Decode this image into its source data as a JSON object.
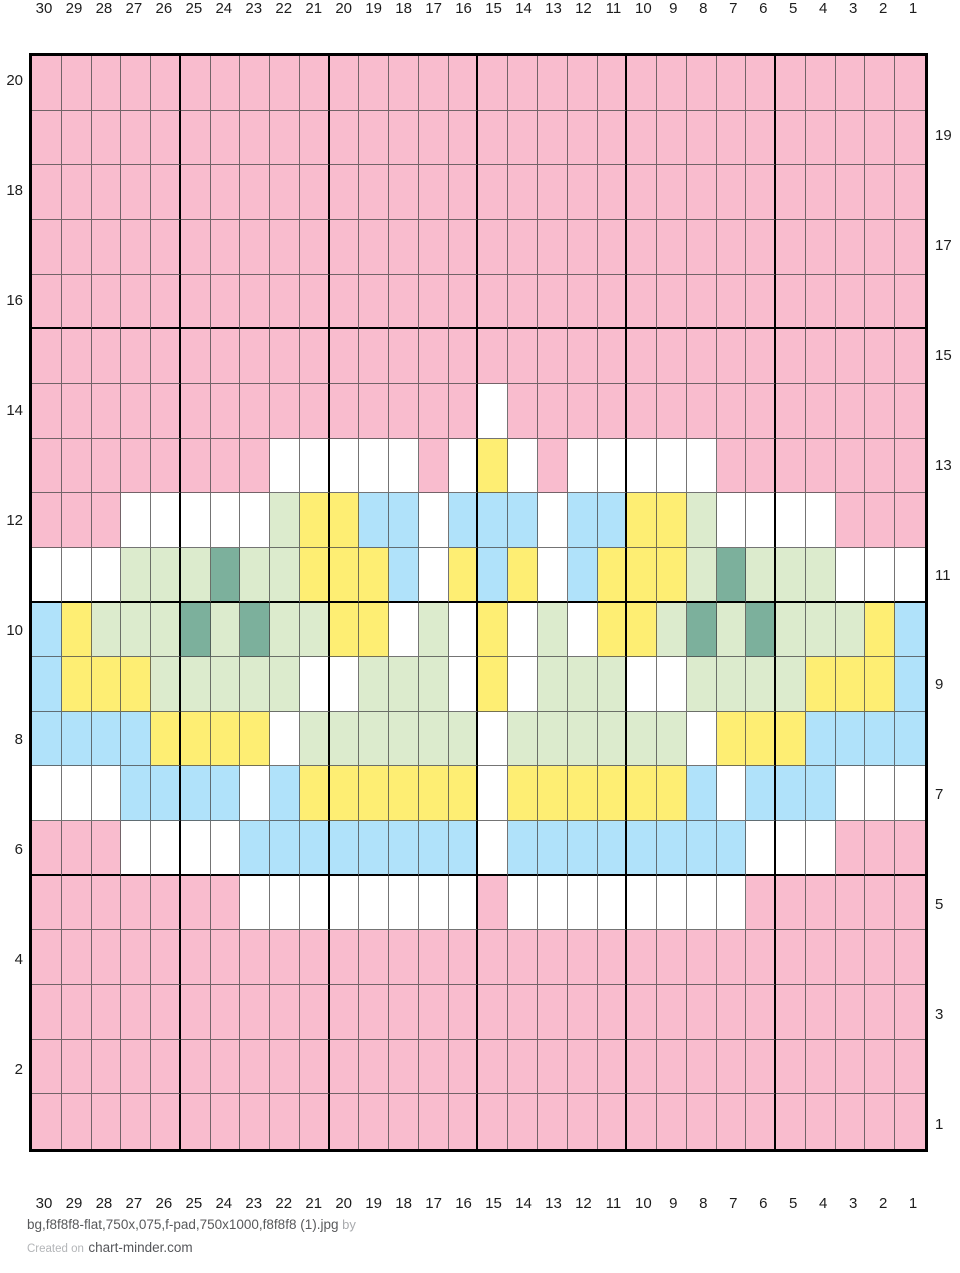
{
  "page": {
    "background": "#ffffff"
  },
  "footer": {
    "filename": "bg,f8f8f8-flat,750x,075,f-pad,750x1000,f8f8f8 (1).jpg",
    "by_label": "by",
    "created_on_label": "Created on",
    "site_link": "chart-minder.com"
  },
  "chart_data": {
    "type": "heatmap",
    "title": "",
    "description": "30-stitch by 20-row knitting colorwork chart with crown-like motif",
    "grid": {
      "columns": 30,
      "rows": 20,
      "thick_line_every": 5,
      "column_numbering": "right-to-left (30 at left edge, 1 at right edge)",
      "row_numbering": "bottom-to-top (even numbers labeled on left, odd on right)"
    },
    "column_labels": [
      "30",
      "29",
      "28",
      "27",
      "26",
      "25",
      "24",
      "23",
      "22",
      "21",
      "20",
      "19",
      "18",
      "17",
      "16",
      "15",
      "14",
      "13",
      "12",
      "11",
      "10",
      "9",
      "8",
      "7",
      "6",
      "5",
      "4",
      "3",
      "2",
      "1"
    ],
    "palette": {
      "P": "#f9bcce",
      "W": "#ffffff",
      "Y": "#feee73",
      "B": "#b0e2fa",
      "G": "#dcebcd",
      "D": "#7cb09c"
    },
    "palette_names": {
      "P": "pink",
      "W": "white",
      "Y": "yellow",
      "B": "light-blue",
      "G": "light-green",
      "D": "teal-green"
    },
    "rows": [
      {
        "number": 20,
        "label_side": "left",
        "cells": "PPPPPPPPPPPPPPPPPPPPPPPPPPPPPP"
      },
      {
        "number": 19,
        "label_side": "right",
        "cells": "PPPPPPPPPPPPPPPPPPPPPPPPPPPPPP"
      },
      {
        "number": 18,
        "label_side": "left",
        "cells": "PPPPPPPPPPPPPPPPPPPPPPPPPPPPPP"
      },
      {
        "number": 17,
        "label_side": "right",
        "cells": "PPPPPPPPPPPPPPPPPPPPPPPPPPPPPP"
      },
      {
        "number": 16,
        "label_side": "left",
        "cells": "PPPPPPPPPPPPPPPPPPPPPPPPPPPPPP"
      },
      {
        "number": 15,
        "label_side": "right",
        "cells": "PPPPPPPPPPPPPPPPPPPPPPPPPPPPPP"
      },
      {
        "number": 14,
        "label_side": "left",
        "cells": "PPPPPPPPPPPPPPPWPPPPPPPPPPPPPP"
      },
      {
        "number": 13,
        "label_side": "right",
        "cells": "PPPPPPPPWWWWWPWYWPWWWWWPPPPPPP"
      },
      {
        "number": 12,
        "label_side": "left",
        "cells": "PPPWWWWWGYYBBWBBBWBBYYGWWWWPPP"
      },
      {
        "number": 11,
        "label_side": "right",
        "cells": "WWWGGGDGGYYYBWYBYWBYYYGDGGGWWW"
      },
      {
        "number": 10,
        "label_side": "left",
        "cells": "BYGGGDGDGGYYWGWYWGWYYGDGDGGGYB"
      },
      {
        "number": 9,
        "label_side": "right",
        "cells": "BYYYGGGGGWWGGGWYWGGGWWGGGGYYYB"
      },
      {
        "number": 8,
        "label_side": "left",
        "cells": "BBBBYYYYWGGGGGGWGGGGGGWYYYBBBB"
      },
      {
        "number": 7,
        "label_side": "right",
        "cells": "WWWBBBBWBYYYYYYWYYYYYYBWBBBWWW"
      },
      {
        "number": 6,
        "label_side": "left",
        "cells": "PPPWWWWBBBBBBBBWBBBBBBBBWWWPPP"
      },
      {
        "number": 5,
        "label_side": "right",
        "cells": "PPPPPPPWWWWWWWWPWWWWWWWWPPPPPP"
      },
      {
        "number": 4,
        "label_side": "left",
        "cells": "PPPPPPPPPPPPPPPPPPPPPPPPPPPPPP"
      },
      {
        "number": 3,
        "label_side": "right",
        "cells": "PPPPPPPPPPPPPPPPPPPPPPPPPPPPPP"
      },
      {
        "number": 2,
        "label_side": "left",
        "cells": "PPPPPPPPPPPPPPPPPPPPPPPPPPPPPP"
      },
      {
        "number": 1,
        "label_side": "right",
        "cells": "PPPPPPPPPPPPPPPPPPPPPPPPPPPPPP"
      }
    ]
  }
}
